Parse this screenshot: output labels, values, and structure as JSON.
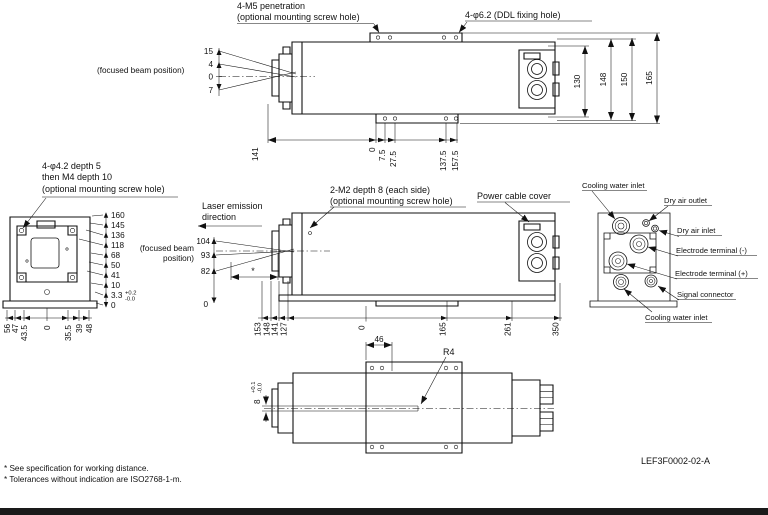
{
  "top_view": {
    "label_m5_1": "4-M5 penetration",
    "label_m5_2": "(optional mounting screw hole)",
    "label_ddl": "4-φ6.2 (DDL fixing hole)",
    "focused_beam_label": "(focused beam position)",
    "beam_dims": [
      "15",
      "4",
      "0",
      "7"
    ],
    "right_dims": [
      "130",
      "148",
      "150",
      "165"
    ],
    "bottom_dims": [
      "141",
      "0",
      "7.5",
      "27.5",
      "137.5",
      "157.5"
    ]
  },
  "front_view": {
    "label_1": "4-φ4.2 depth 5",
    "label_2": "then M4 depth 10",
    "label_3": "(optional mounting screw hole)",
    "right_dims": [
      "160",
      "145",
      "136",
      "118",
      "68",
      "50",
      "41",
      "10",
      "3.3",
      "0"
    ],
    "tol_plus": "+0.2",
    "tol_minus": "-0.0",
    "bottom_dims": [
      "56",
      "47",
      "43.5",
      "0",
      "35.5",
      "39",
      "48"
    ]
  },
  "side_view": {
    "laser_dir_1": "Laser emission",
    "laser_dir_2": "direction",
    "label_m2_1": "2-M2 depth 8 (each side)",
    "label_m2_2": "(optional mounting screw hole)",
    "label_power": "Power cable cover",
    "focused_beam_1": "(focused beam",
    "focused_beam_2": "position)",
    "left_dims": [
      "104",
      "93",
      "82"
    ],
    "zero_label": "0",
    "working_distance_mark": "*",
    "bottom_dims": [
      "153",
      "148",
      "141",
      "127",
      "0",
      "165",
      "261",
      "350"
    ]
  },
  "rear_view": {
    "labels": [
      "Cooling water inlet",
      "Dry air outlet",
      "Dry air inlet",
      "Electrode terminal (-)",
      "Electrode terminal (+)",
      "Signal connector",
      "Cooling water inlet"
    ]
  },
  "bottom_view": {
    "dim_width": "46",
    "radius_label": "R4",
    "dim_slot": "8",
    "tol_plus": "+0.1",
    "tol_minus": "-0.0"
  },
  "footer": {
    "note1": "* See specification for working distance.",
    "note2": "* Tolerances without indication are ISO2768-1-m.",
    "drawing_number": "LEF3F0002-02-A"
  }
}
